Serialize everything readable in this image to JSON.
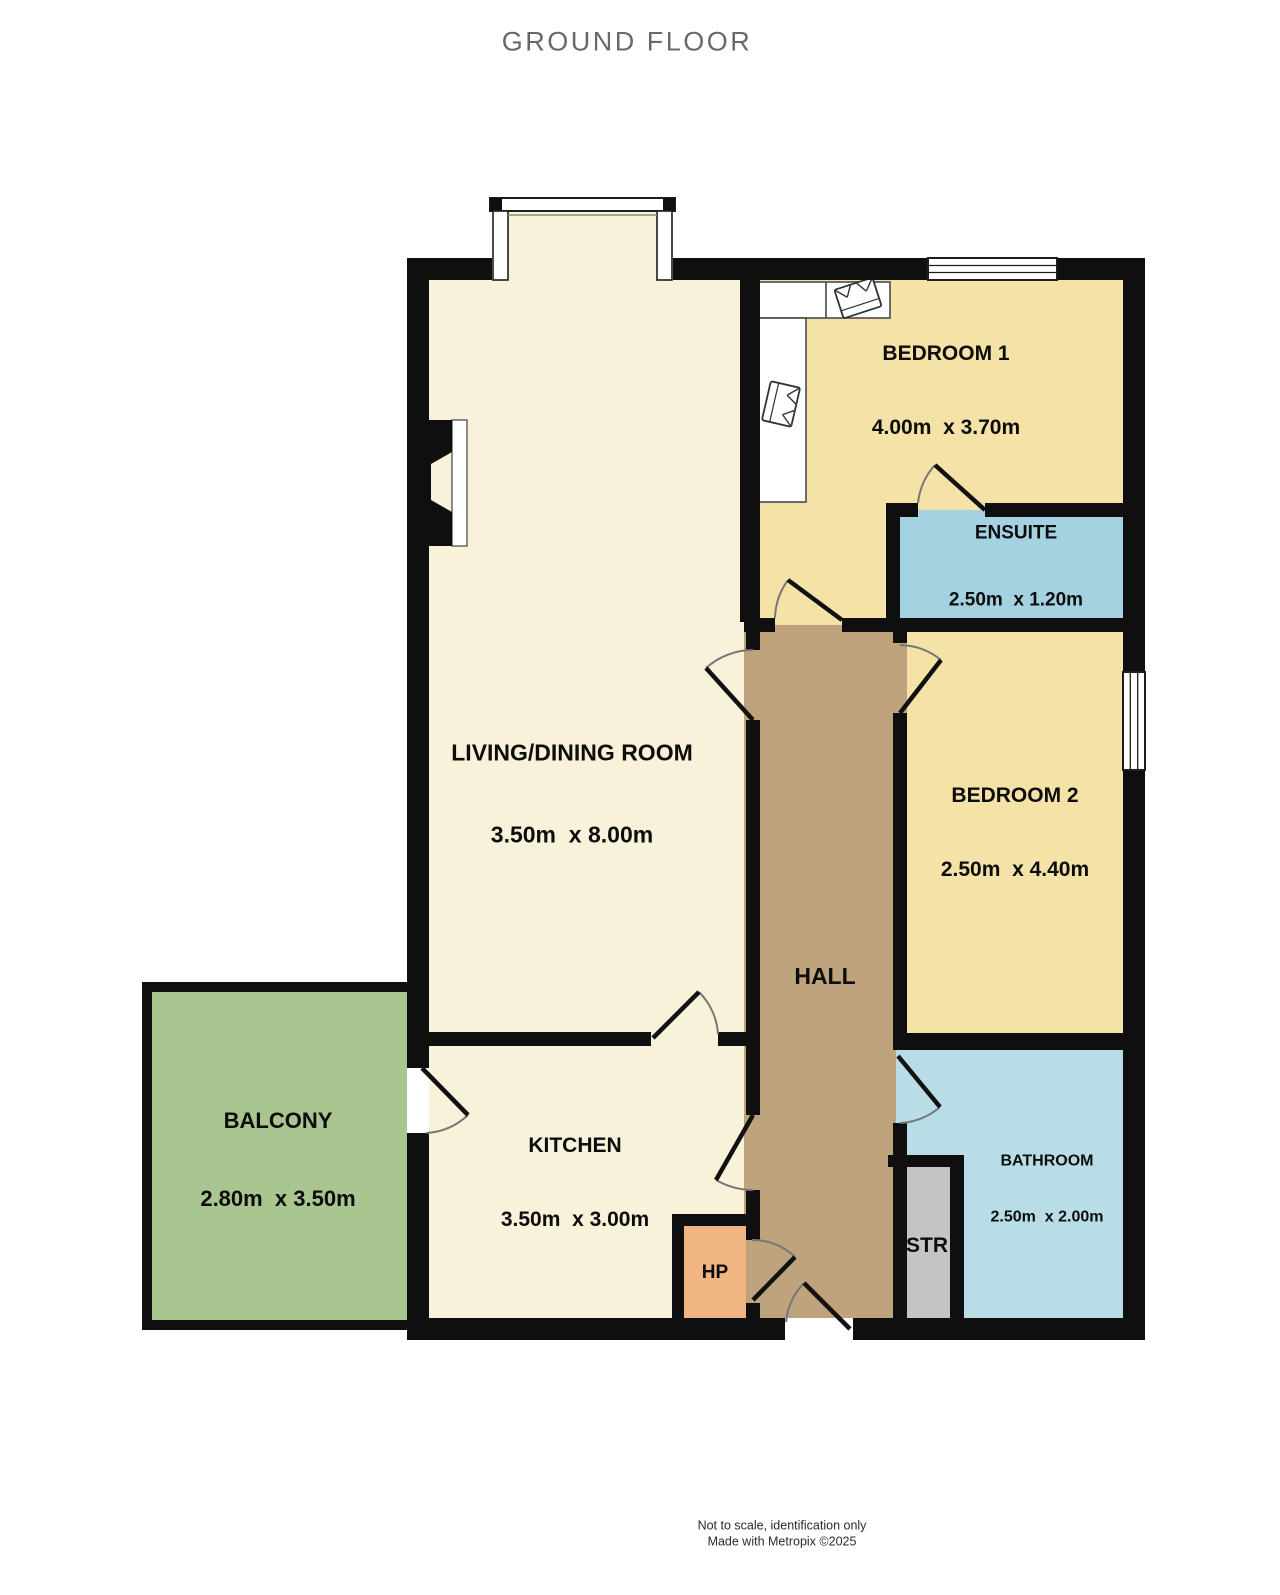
{
  "title": "GROUND FLOOR",
  "rooms": {
    "living": {
      "name": "LIVING/DINING ROOM",
      "dims": "3.50m  x 8.00m"
    },
    "bedroom1": {
      "name": "BEDROOM 1",
      "dims": "4.00m  x 3.70m"
    },
    "ensuite": {
      "name": "ENSUITE",
      "dims": "2.50m  x 1.20m"
    },
    "bedroom2": {
      "name": "BEDROOM 2",
      "dims": "2.50m  x 4.40m"
    },
    "hall": {
      "name": "HALL"
    },
    "kitchen": {
      "name": "KITCHEN",
      "dims": "3.50m  x 3.00m"
    },
    "balcony": {
      "name": "BALCONY",
      "dims": "2.80m  x 3.50m"
    },
    "bathroom": {
      "name": "BATHROOM",
      "dims": "2.50m  x 2.00m"
    },
    "hp": {
      "name": "HP"
    },
    "str": {
      "name": "STR"
    }
  },
  "colors": {
    "living_kitchen": "#f7f2d9",
    "bedroom": "#f4e2a7",
    "ensuite": "#a5d2e1",
    "bathroom": "#b9dde6",
    "hall": "#bea37c",
    "balcony": "#a9c690",
    "hp": "#f0b583",
    "str": "#c4c3c5",
    "wall": "#0f0f0f"
  },
  "footer": {
    "line1": "Not to scale, identification only",
    "line2": "Made with Metropix ©2025"
  }
}
